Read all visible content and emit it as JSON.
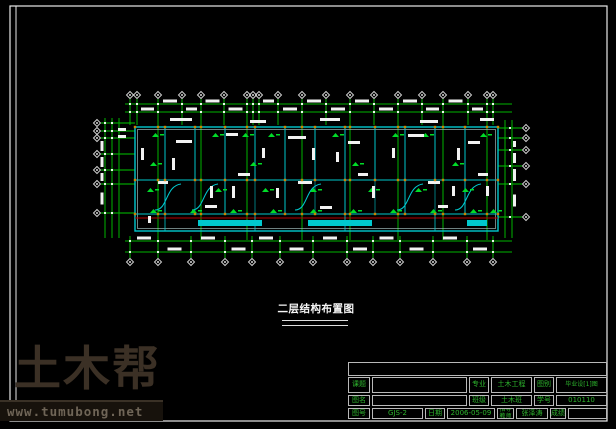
{
  "caption": {
    "text": "二层结构布置图"
  },
  "watermark": {
    "logo": "土木帮",
    "url": "www.tumubong.net"
  },
  "title_block": {
    "row1": {
      "l1": "课题",
      "v1": "",
      "l2": "专业",
      "v2": "土木工程",
      "l3": "图别",
      "v3": "毕业设[1]图"
    },
    "row2": {
      "l1": "图名",
      "v1": "",
      "l2": "班级",
      "v2": "土木班",
      "l3": "学号",
      "v3": "010110"
    },
    "row3": {
      "l1": "图号",
      "v1": "GJS-2",
      "l2": "日期",
      "v2": "2006-05-09",
      "l3": "指导教师",
      "v3": "张泽涛",
      "l4": "成绩",
      "v4": ""
    }
  },
  "colors": {
    "grid_green": "#00c800",
    "dim_green": "#00b400",
    "beam_cyan": "#00c8cd",
    "wall_gray": "#9fb8b8",
    "annotation_white": "#f2f2f2",
    "axis_red": "#b40000",
    "marker_green": "#00dc28",
    "bubble_gray": "#cfcfcf",
    "sheet_border": "#e8e8e8",
    "watermark_logo_color": "#3b3025",
    "watermark_url_color": "#6f6557"
  }
}
